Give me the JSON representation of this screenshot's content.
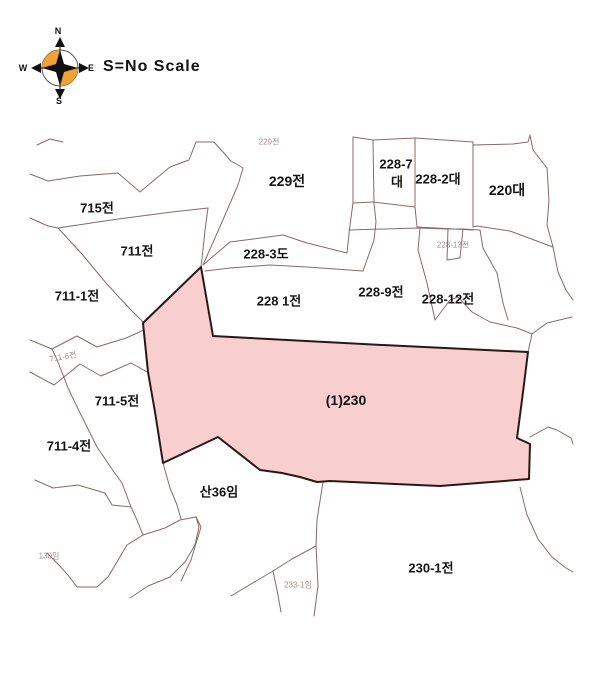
{
  "header": {
    "scale_note": "S=No Scale",
    "compass": {
      "north": "N",
      "south": "S",
      "east": "E",
      "west": "W"
    },
    "compass_color": "#F2A233"
  },
  "map": {
    "highlight_color": "#F8CECE",
    "highlight_border_color": "#2A1818",
    "boundary_color": "#8A6868",
    "highlighted_parcel": "(1)230",
    "parcel_labels": {
      "p229_faint": "229전",
      "p229": "229전",
      "p228_7_no": "228-7",
      "p228_7_suffix": "대",
      "p228_2": "228-2대",
      "p220": "220대",
      "p715": "715전",
      "p711": "711전",
      "p711_1": "711-1전",
      "p228_3": "228-3도",
      "p228_1": "228 1전",
      "p228_9": "228-9전",
      "p228_12": "228-12전",
      "p228_13_faint": "228-13전",
      "p230": "(1)230",
      "p711_5": "711-5전",
      "p711_4": "711-4전",
      "p711_6_faint": "711-6전",
      "san36": "산36임",
      "p130_faint": "130임",
      "p233_1_faint": "233-1임",
      "p230_1": "230-1전"
    }
  }
}
